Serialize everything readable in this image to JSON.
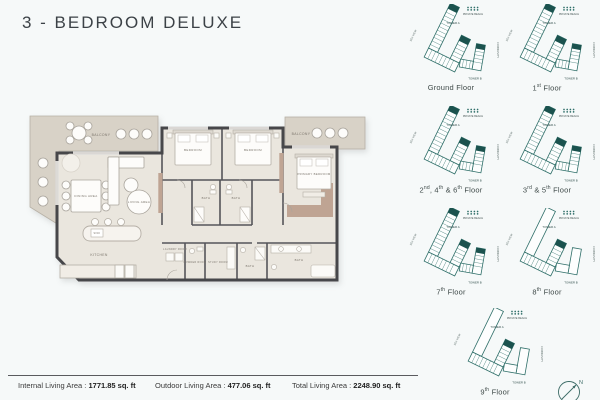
{
  "title": "3 - BEDROOM DELUXE",
  "floor_plan": {
    "rooms": {
      "balcony_left": "BALCONY",
      "balcony_right": "BALCONY",
      "dining": "DINING AREA",
      "living": "LIVING AREA",
      "kitchen": "KITCHEN",
      "sink": "SINK",
      "bedroom_1": "BEDROOM",
      "bedroom_2": "BEDROOM",
      "primary_bedroom": "PRIMARY BEDROOM",
      "bath_1": "BATH",
      "bath_2": "BATH",
      "bath_3": "BATH",
      "primary_bath": "BATH",
      "laundry_room": "LAUNDRY ROOM",
      "powder_room": "POWDER ROOM",
      "study_room": "STUDY ROOM"
    }
  },
  "keyplans": {
    "labels": {
      "tower_a": "TOWER A",
      "tower_b": "TOWER B",
      "private_beach": "PRIVATE BEACH",
      "community": "COMMUNITY",
      "sea_view": "SEA VIEW"
    },
    "floors": [
      {
        "label": "Ground Floor",
        "variant": "full"
      },
      {
        "label": "1st Floor",
        "variant": "full"
      },
      {
        "label": "2nd, 4th & 6th Floor",
        "variant": "full"
      },
      {
        "label": "3rd & 5th Floor",
        "variant": "full"
      },
      {
        "label": "7th Floor",
        "variant": "full"
      },
      {
        "label": "8th Floor",
        "variant": "partial"
      },
      {
        "label": "9th Floor",
        "variant": "partial"
      }
    ],
    "colors": {
      "teal_core": "#1b524e",
      "teal_outline": "#2f6f69"
    }
  },
  "compass": {
    "north_label": "N"
  },
  "footer": {
    "stats": [
      {
        "label": "Internal Living Area :",
        "value": "1771.85 sq. ft"
      },
      {
        "label": "Outdoor Living Area :",
        "value": "477.06 sq. ft"
      },
      {
        "label": "Total Living Area :",
        "value": "2248.90 sq. ft"
      }
    ]
  }
}
